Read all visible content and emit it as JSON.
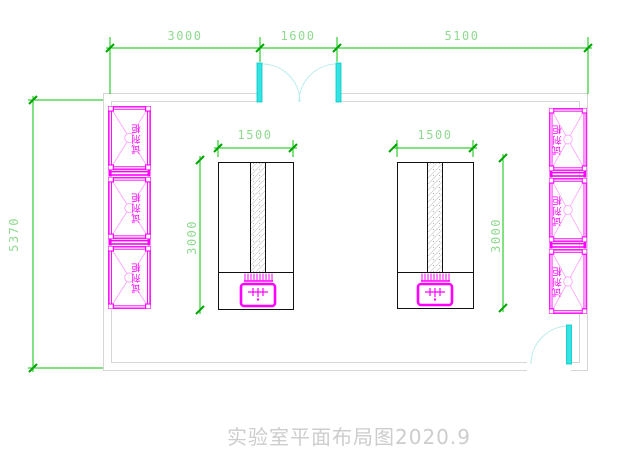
{
  "drawing": {
    "title": "实验室平面布局图2020.9",
    "type_note": "laboratory floor plan"
  },
  "dimensions": {
    "top_segments": [
      "3000",
      "1600",
      "5100"
    ],
    "room_height": "5370",
    "bench_width": "1500",
    "bench_depth": "3000"
  },
  "cabinets": {
    "label": "试剂柜",
    "count_left": 3,
    "count_right": 3
  },
  "colors": {
    "dimension_line_green": "#00c400",
    "dimension_text_green": "#8fda8f",
    "cabinet_magenta": "#ff00ff",
    "door_cyan": "#35e3e3",
    "door_arc_cyan": "#b8ecec",
    "wall_gray": "#d6d6d6",
    "bench_black": "#111111",
    "title_gray": "#cdcdcd"
  }
}
